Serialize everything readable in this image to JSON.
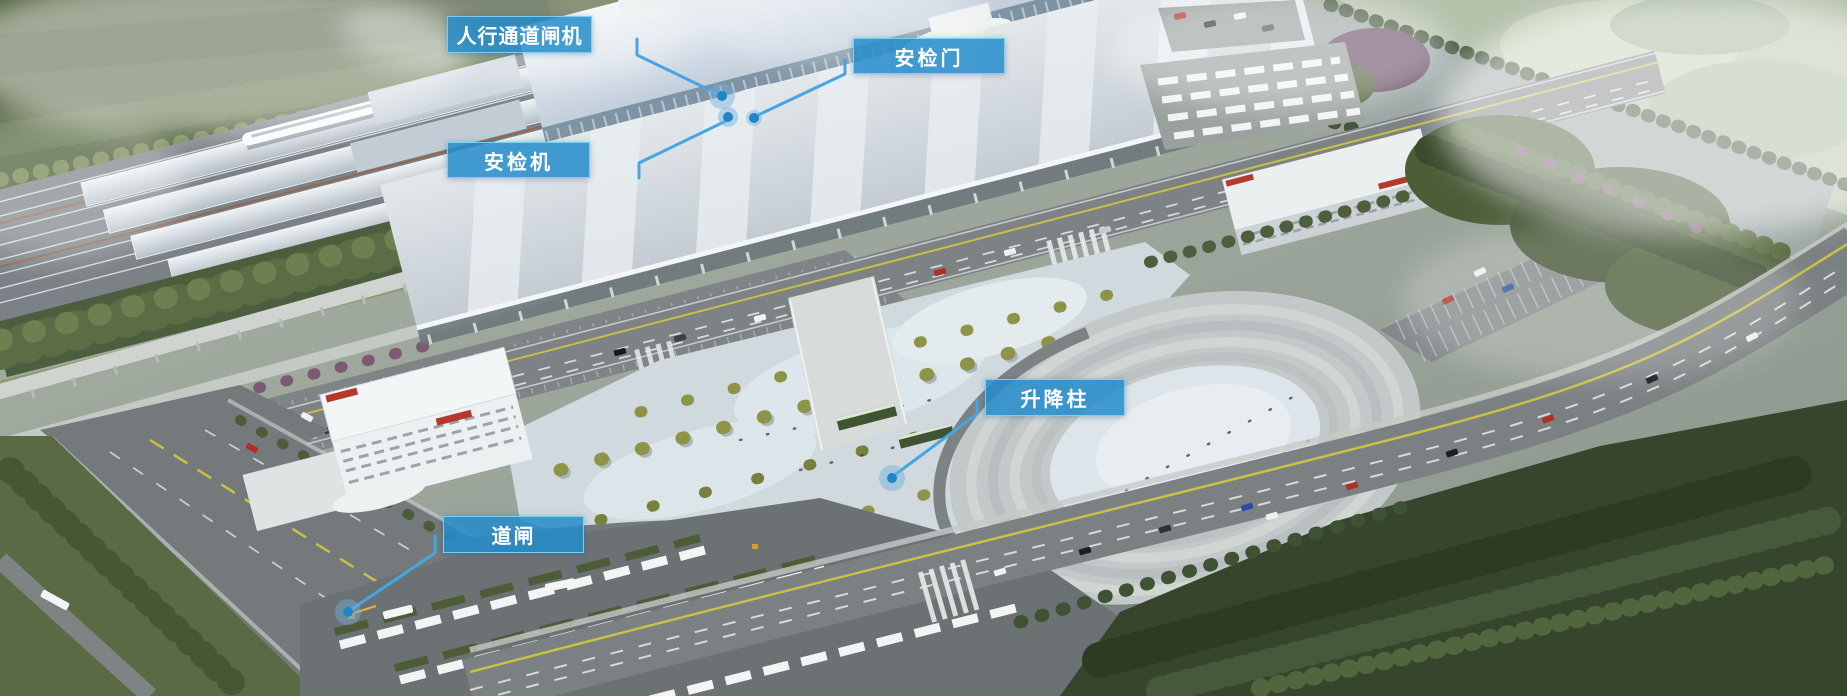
{
  "callouts": [
    {
      "id": "pedestrian-gate-machine",
      "label": "人行通道闸机"
    },
    {
      "id": "security-door",
      "label": "安检门"
    },
    {
      "id": "security-scanner",
      "label": "安检机"
    },
    {
      "id": "lift-bollard",
      "label": "升降柱"
    },
    {
      "id": "road-barrier-gate",
      "label": "道闸"
    }
  ],
  "colors": {
    "callout_fill": "#2490cc",
    "callout_border": "#82d0f4",
    "callout_text": "#ffffff",
    "leader_line": "#46a6e3",
    "marker_dot": "#1f86c8",
    "marker_halo": "rgba(110,175,220,0.45)"
  }
}
